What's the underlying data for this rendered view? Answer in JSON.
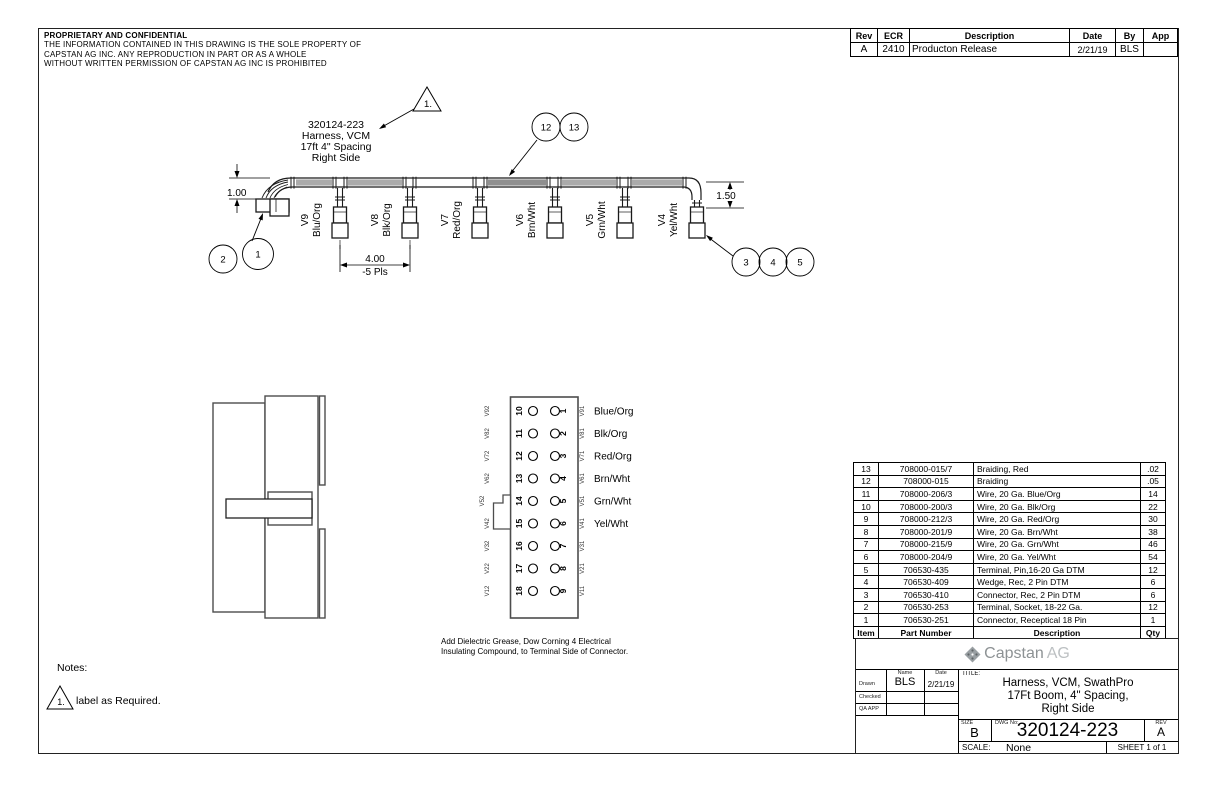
{
  "proprietary": {
    "title": "PROPRIETARY AND CONFIDENTIAL",
    "line1": "THE INFORMATION CONTAINED IN THIS DRAWING IS THE SOLE PROPERTY OF",
    "line2": "CAPSTAN AG INC. ANY REPRODUCTION IN PART OR AS A WHOLE",
    "line3": "WITHOUT WRITTEN PERMISSION OF CAPSTAN AG INC IS PROHIBITED"
  },
  "revision_table": {
    "headers": [
      "Rev",
      "ECR",
      "Description",
      "Date",
      "By",
      "App"
    ],
    "row": {
      "rev": "A",
      "ecr": "2410",
      "description": "Producton Release",
      "date": "2/21/19",
      "by": "BLS",
      "app": ""
    }
  },
  "harness": {
    "flag": "1.",
    "label": {
      "line1": "320124-223",
      "line2": "Harness, VCM",
      "line3": "17ft 4\" Spacing",
      "line4": "Right Side"
    },
    "balloons": {
      "b1": "1",
      "b2": "2",
      "b3": "3",
      "b4": "4",
      "b5": "5",
      "b12": "12",
      "b13": "13"
    },
    "dims": {
      "left_height": "1.00",
      "right_height": "1.50",
      "spacing": "4.00",
      "spacing_note": "-5 Pls"
    },
    "drops": [
      {
        "id": "V9",
        "color": "Blu/Org"
      },
      {
        "id": "V8",
        "color": "Blk/Org"
      },
      {
        "id": "V7",
        "color": "Red/Org"
      },
      {
        "id": "V6",
        "color": "Brn/Wht"
      },
      {
        "id": "V5",
        "color": "Grn/Wht"
      },
      {
        "id": "V4",
        "color": "Yel/Wht"
      }
    ]
  },
  "pin_diagram": {
    "rows": [
      {
        "left_outer": "V92",
        "left_pin": "10",
        "right_pin": "1",
        "right_outer": "V91",
        "wire": "Blue/Org"
      },
      {
        "left_outer": "V82",
        "left_pin": "11",
        "right_pin": "2",
        "right_outer": "V81",
        "wire": "Blk/Org"
      },
      {
        "left_outer": "V72",
        "left_pin": "12",
        "right_pin": "3",
        "right_outer": "V71",
        "wire": "Red/Org"
      },
      {
        "left_outer": "V62",
        "left_pin": "13",
        "right_pin": "4",
        "right_outer": "V61",
        "wire": "Brn/Wht"
      },
      {
        "left_outer": "V52",
        "left_pin": "14",
        "right_pin": "5",
        "right_outer": "V51",
        "wire": "Grn/Wht"
      },
      {
        "left_outer": "V42",
        "left_pin": "15",
        "right_pin": "6",
        "right_outer": "V41",
        "wire": "Yel/Wht"
      },
      {
        "left_outer": "V32",
        "left_pin": "16",
        "right_pin": "7",
        "right_outer": "V31",
        "wire": ""
      },
      {
        "left_outer": "V22",
        "left_pin": "17",
        "right_pin": "8",
        "right_outer": "V21",
        "wire": ""
      },
      {
        "left_outer": "V12",
        "left_pin": "18",
        "right_pin": "9",
        "right_outer": "V11",
        "wire": ""
      }
    ],
    "note1": "Add Dielectric Grease, Dow Corning 4 Electrical",
    "note2": "Insulating Compound, to Terminal Side of Connector."
  },
  "notes": {
    "title": "Notes:",
    "flag": "1.",
    "text": "label as Required."
  },
  "bom": {
    "headers": {
      "item": "Item",
      "part": "Part Number",
      "description": "Description",
      "qty": "Qty"
    },
    "rows": [
      {
        "item": "13",
        "part": "708000-015/7",
        "description": "Braiding, Red",
        "qty": ".02"
      },
      {
        "item": "12",
        "part": "708000-015",
        "description": "Braiding",
        "qty": ".05"
      },
      {
        "item": "11",
        "part": "708000-206/3",
        "description": "Wire, 20 Ga. Blue/Org",
        "qty": "14"
      },
      {
        "item": "10",
        "part": "708000-200/3",
        "description": "Wire, 20 Ga. Blk/Org",
        "qty": "22"
      },
      {
        "item": "9",
        "part": "708000-212/3",
        "description": "Wire, 20 Ga. Red/Org",
        "qty": "30"
      },
      {
        "item": "8",
        "part": "708000-201/9",
        "description": "Wire, 20 Ga. Brn/Wht",
        "qty": "38"
      },
      {
        "item": "7",
        "part": "708000-215/9",
        "description": "Wire, 20 Ga. Grn/Wht",
        "qty": "46"
      },
      {
        "item": "6",
        "part": "708000-204/9",
        "description": "Wire, 20 Ga. Yel/Wht",
        "qty": "54"
      },
      {
        "item": "5",
        "part": "706530-435",
        "description": "Terminal, Pin,16-20 Ga DTM",
        "qty": "12"
      },
      {
        "item": "4",
        "part": "706530-409",
        "description": "Wedge, Rec, 2 Pin DTM",
        "qty": "6"
      },
      {
        "item": "3",
        "part": "706530-410",
        "description": "Connector, Rec, 2 Pin DTM",
        "qty": "6"
      },
      {
        "item": "2",
        "part": "706530-253",
        "description": "Terminal, Socket, 18-22 Ga.",
        "qty": "12"
      },
      {
        "item": "1",
        "part": "706530-251",
        "description": "Connector, Receptical 18 Pin",
        "qty": "1"
      }
    ]
  },
  "title_block": {
    "logo": {
      "word1": "Capstan",
      "word2": "AG"
    },
    "approvals": {
      "name_h": "Name",
      "date_h": "Date",
      "drawn": "Drawn",
      "drawn_name": "BLS",
      "drawn_date": "2/21/19",
      "checked": "Checked",
      "qa": "QA APP"
    },
    "title_label": "TITLE:",
    "title1": "Harness, VCM, SwathPro",
    "title2": "17Ft Boom, 4\" Spacing,",
    "title3": "Right Side",
    "size_label": "SIZE",
    "size": "B",
    "dwg_label": "DWG No:",
    "dwg_no": "320124-223",
    "rev_label": "REV",
    "rev": "A",
    "scale_label": "SCALE:",
    "scale": "None",
    "sheet": "SHEET 1 of 1"
  }
}
